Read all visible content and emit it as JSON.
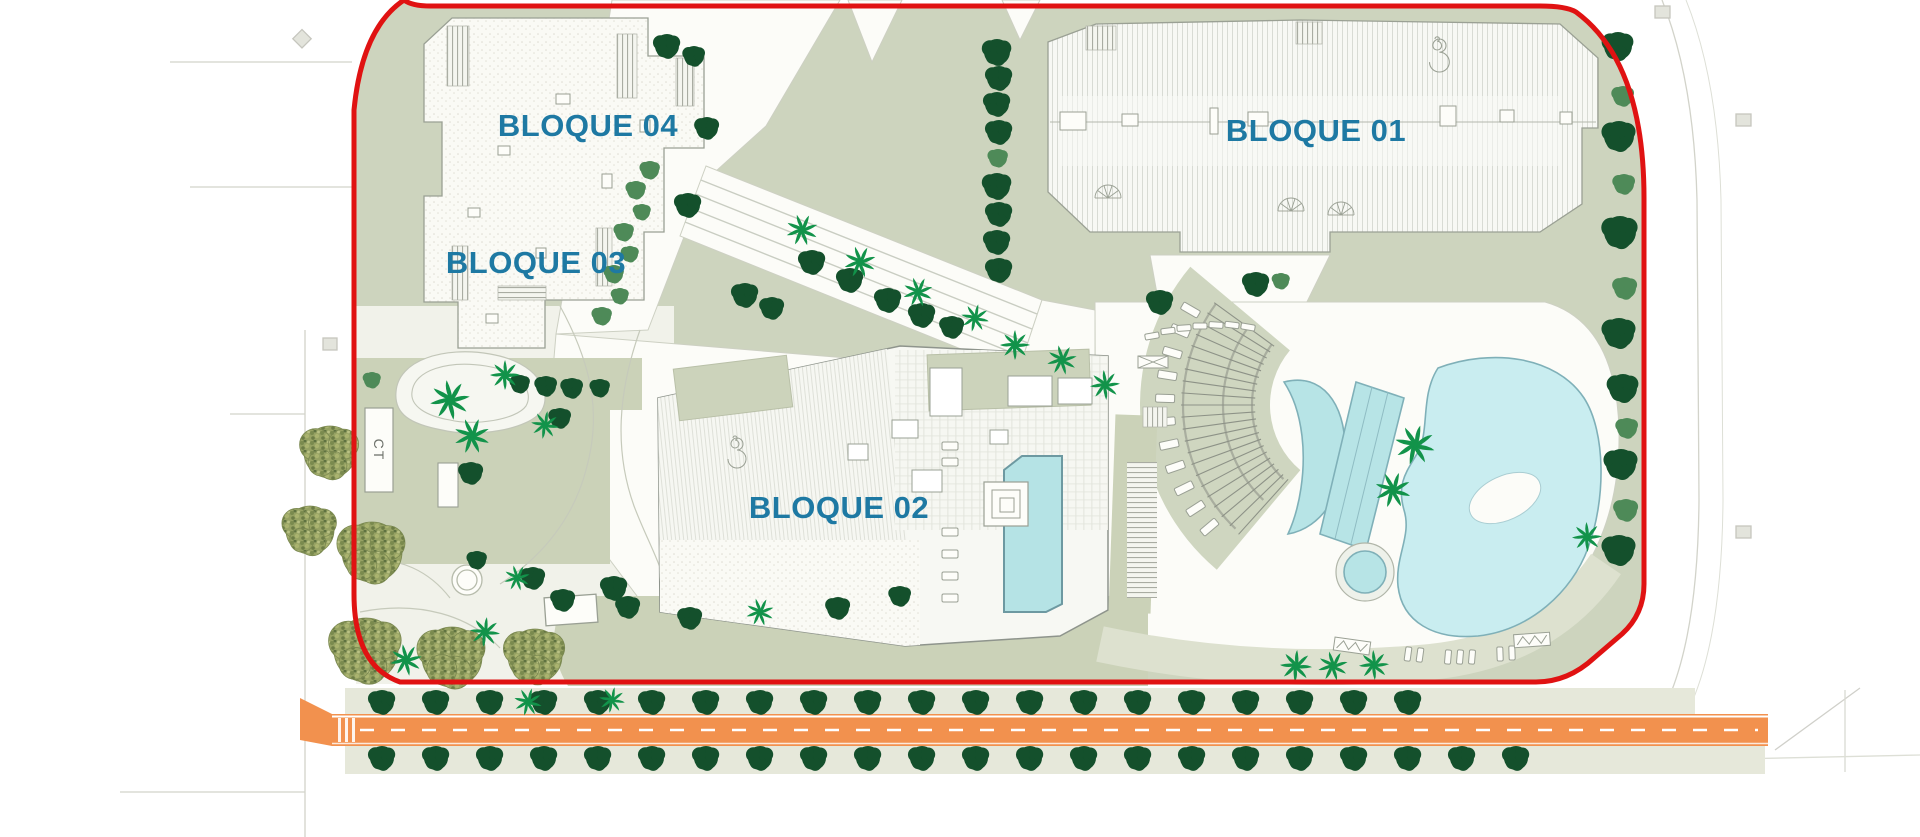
{
  "labels": {
    "bloque01": "BLOQUE 01",
    "bloque02": "BLOQUE 02",
    "bloque03": "BLOQUE 03",
    "bloque04": "BLOQUE 04",
    "ct": "CT"
  },
  "colors": {
    "label_teal": "#1e79a3",
    "boundary_red": "#e01212",
    "site_green": "#cdd4be",
    "patch_green": "#cbd2b8",
    "strip_tan": "#e6e8da",
    "walkway_white": "#fcfcf8",
    "garden_white": "#f1f2ea",
    "road_orange": "#f2914e",
    "pool_blue": "#b7e4e6",
    "lagoon_blue": "#c9edf0",
    "tree_dark": "#14502c",
    "tree_medium": "#4e8a58",
    "palm_green": "#12934a",
    "olive_green": "#96a263",
    "line_gray": "#9aa094"
  },
  "scene": {
    "tree_rows": [
      {
        "y": 702,
        "x_start": 382,
        "count": 20,
        "spacing": 54,
        "r": 12,
        "shade": "d"
      },
      {
        "y": 758,
        "x_start": 382,
        "count": 22,
        "spacing": 54,
        "r": 12,
        "shade": "d"
      }
    ],
    "trees": [
      [
        1618,
        46,
        14,
        "d"
      ],
      [
        1623,
        96,
        10,
        "m"
      ],
      [
        1619,
        136,
        15,
        "d"
      ],
      [
        1624,
        184,
        10,
        "m"
      ],
      [
        1620,
        232,
        16,
        "d"
      ],
      [
        1625,
        288,
        11,
        "m"
      ],
      [
        1619,
        333,
        15,
        "d"
      ],
      [
        1623,
        388,
        14,
        "d"
      ],
      [
        1627,
        428,
        10,
        "m"
      ],
      [
        1621,
        464,
        15,
        "d"
      ],
      [
        1626,
        510,
        11,
        "m"
      ],
      [
        1619,
        550,
        15,
        "d"
      ],
      [
        997,
        52,
        13,
        "d"
      ],
      [
        999,
        78,
        12,
        "d"
      ],
      [
        997,
        104,
        12,
        "d"
      ],
      [
        999,
        132,
        12,
        "d"
      ],
      [
        998,
        158,
        9,
        "m"
      ],
      [
        997,
        186,
        13,
        "d"
      ],
      [
        999,
        214,
        12,
        "d"
      ],
      [
        997,
        242,
        12,
        "d"
      ],
      [
        999,
        270,
        12,
        "d"
      ],
      [
        667,
        46,
        12,
        "d"
      ],
      [
        694,
        56,
        10,
        "d"
      ],
      [
        707,
        128,
        11,
        "d"
      ],
      [
        650,
        170,
        9,
        "m"
      ],
      [
        636,
        190,
        9,
        "m"
      ],
      [
        642,
        212,
        8,
        "m"
      ],
      [
        624,
        232,
        9,
        "m"
      ],
      [
        630,
        254,
        8,
        "m"
      ],
      [
        614,
        274,
        9,
        "m"
      ],
      [
        620,
        296,
        8,
        "m"
      ],
      [
        602,
        316,
        9,
        "m"
      ],
      [
        520,
        384,
        9,
        "d"
      ],
      [
        546,
        386,
        10,
        "d"
      ],
      [
        572,
        388,
        10,
        "d"
      ],
      [
        600,
        388,
        9,
        "d"
      ],
      [
        372,
        380,
        8,
        "m"
      ],
      [
        688,
        205,
        12,
        "d"
      ],
      [
        745,
        295,
        12,
        "d"
      ],
      [
        772,
        308,
        11,
        "d"
      ],
      [
        812,
        262,
        12,
        "d"
      ],
      [
        850,
        280,
        12,
        "d"
      ],
      [
        888,
        300,
        12,
        "d"
      ],
      [
        922,
        315,
        12,
        "d"
      ],
      [
        952,
        327,
        11,
        "d"
      ],
      [
        1256,
        284,
        12,
        "d"
      ],
      [
        1281,
        281,
        8,
        "m"
      ],
      [
        1160,
        302,
        12,
        "d"
      ],
      [
        560,
        418,
        10,
        "d"
      ],
      [
        471,
        473,
        11,
        "d"
      ],
      [
        533,
        578,
        11,
        "d"
      ],
      [
        563,
        600,
        11,
        "d"
      ],
      [
        614,
        588,
        12,
        "d"
      ],
      [
        628,
        607,
        11,
        "d"
      ],
      [
        690,
        618,
        11,
        "d"
      ],
      [
        838,
        608,
        11,
        "d"
      ],
      [
        900,
        596,
        10,
        "d"
      ],
      [
        477,
        560,
        9,
        "d"
      ]
    ],
    "palms": [
      [
        802,
        230,
        16
      ],
      [
        860,
        262,
        16
      ],
      [
        918,
        292,
        15
      ],
      [
        975,
        318,
        14
      ],
      [
        1015,
        345,
        15
      ],
      [
        1062,
        360,
        15
      ],
      [
        1105,
        385,
        15
      ],
      [
        450,
        400,
        20
      ],
      [
        472,
        436,
        18
      ],
      [
        505,
        375,
        15
      ],
      [
        545,
        425,
        14
      ],
      [
        406,
        660,
        16
      ],
      [
        485,
        632,
        15
      ],
      [
        517,
        578,
        13
      ],
      [
        528,
        702,
        14
      ],
      [
        612,
        700,
        13
      ],
      [
        760,
        612,
        14
      ],
      [
        1415,
        445,
        20
      ],
      [
        1393,
        490,
        18
      ],
      [
        1587,
        537,
        15
      ],
      [
        1296,
        666,
        16
      ],
      [
        1333,
        666,
        15
      ],
      [
        1374,
        665,
        15
      ]
    ],
    "olives": [
      [
        330,
        452,
        26
      ],
      [
        310,
        530,
        24
      ],
      [
        372,
        552,
        30
      ],
      [
        366,
        650,
        32
      ],
      [
        452,
        657,
        30
      ],
      [
        535,
        656,
        27
      ]
    ],
    "loungers": [
      [
        1152,
        336,
        6,
        14,
        80
      ],
      [
        1168,
        331,
        6,
        14,
        83
      ],
      [
        1184,
        328,
        6,
        14,
        86
      ],
      [
        1200,
        326,
        6,
        14,
        90
      ],
      [
        1216,
        325,
        6,
        14,
        94
      ],
      [
        1232,
        325,
        6,
        14,
        97
      ],
      [
        1248,
        327,
        6,
        14,
        100
      ],
      [
        950,
        446,
        16,
        8,
        0
      ],
      [
        950,
        462,
        16,
        8,
        0
      ],
      [
        950,
        532,
        16,
        8,
        0
      ],
      [
        950,
        554,
        16,
        8,
        0
      ],
      [
        950,
        576,
        16,
        8,
        0
      ],
      [
        950,
        598,
        16,
        8,
        0
      ],
      [
        1408,
        654,
        6,
        14,
        8
      ],
      [
        1420,
        655,
        6,
        14,
        8
      ],
      [
        1448,
        657,
        6,
        14,
        5
      ],
      [
        1460,
        657,
        6,
        14,
        5
      ],
      [
        1472,
        657,
        6,
        14,
        5
      ],
      [
        1500,
        654,
        6,
        14,
        -2
      ],
      [
        1512,
        653,
        6,
        14,
        -2
      ]
    ],
    "pergola": {
      "cx": 1355,
      "cy": 405,
      "a0": 130,
      "a1": 220,
      "r_in": 85,
      "r_out": 215,
      "arc_radii": [
        103,
        132,
        172
      ],
      "tick_step": 4,
      "tick_r0": 100,
      "tick_r1": 174,
      "thick_step": 12,
      "lounger_r": 190,
      "lounger_a0": 140,
      "lounger_a1": 212,
      "lounger_step": 7
    },
    "zigzags": [
      [
        1352,
        646,
        8
      ],
      [
        1532,
        640,
        -4
      ]
    ],
    "fans": [
      [
        1108,
        198
      ],
      [
        1291,
        211
      ],
      [
        1341,
        215
      ]
    ],
    "spirals": [
      [
        733,
        438,
        10
      ],
      [
        1435,
        39,
        11
      ]
    ]
  }
}
